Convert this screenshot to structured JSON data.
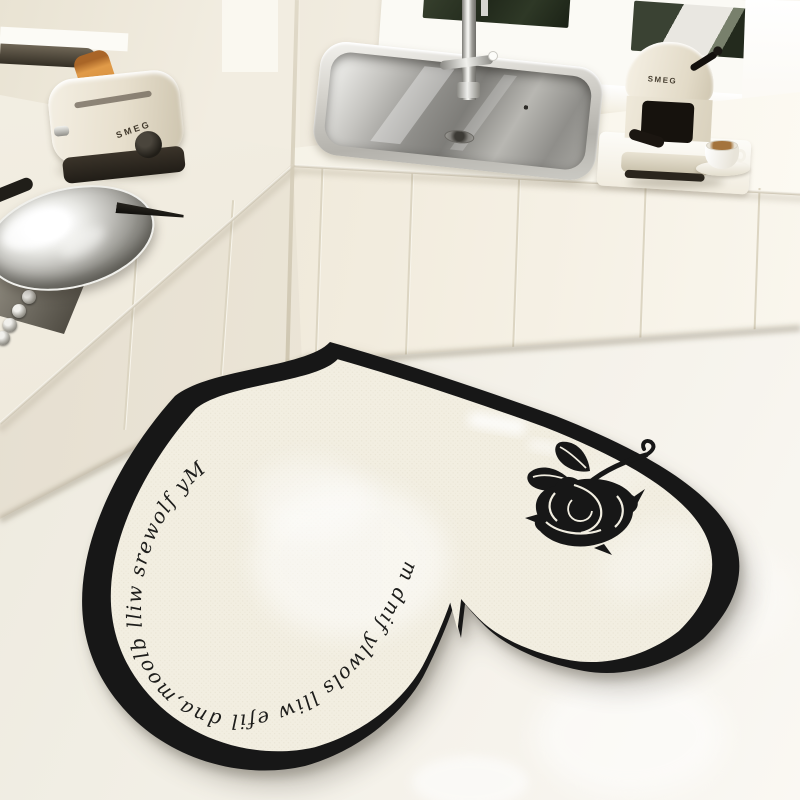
{
  "scene": {
    "title": "Cream kitchen with heart-shaped anti-slip floor mat",
    "style": "product photograph"
  },
  "appliances": {
    "toaster": {
      "brand": "SMEG"
    },
    "coffee_machine": {
      "brand": "SMEG"
    }
  },
  "mat": {
    "text": "My flowers will bloom,and life will slowly find me.",
    "motif": "black-rose",
    "shape": "heart",
    "border_color": "#171717",
    "field_color": "#f2eee1"
  },
  "palette": {
    "wall": "#f1ecdf",
    "counter": "#f7f3e9",
    "cabinet": "#efe9da",
    "floor": "#f2efe6",
    "window_green": "#2b3425",
    "toast": "#d8913e",
    "steel": "#b5b3ad"
  }
}
